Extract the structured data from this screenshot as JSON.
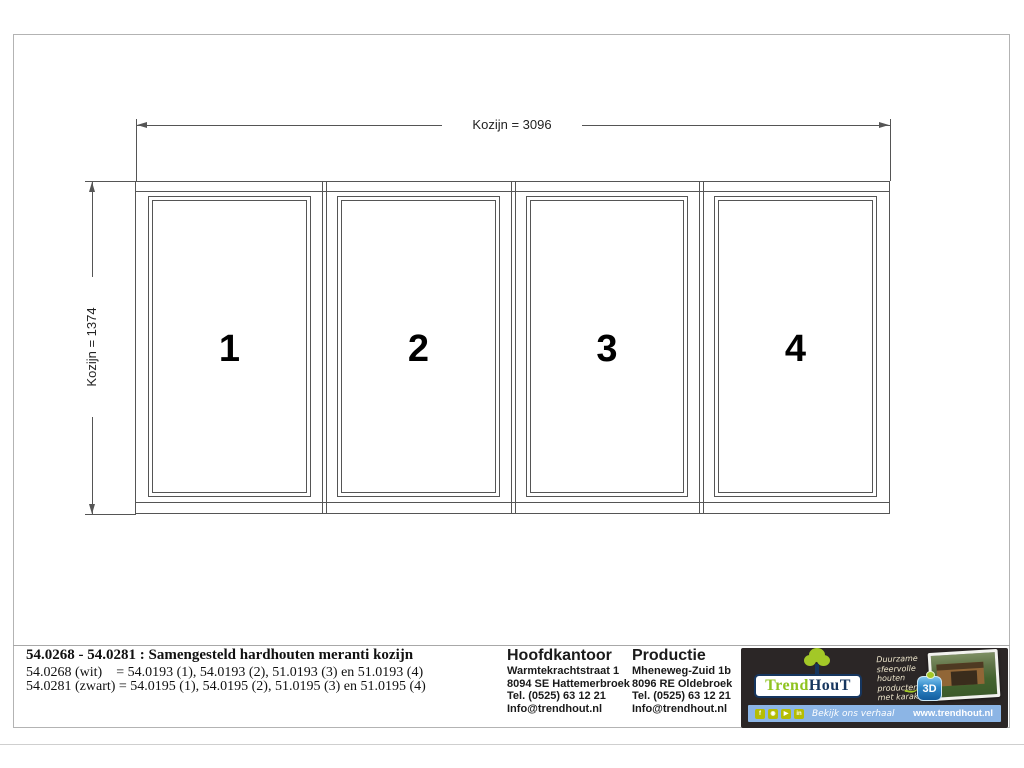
{
  "drawing": {
    "width_dimension_label": "Kozijn = 3096",
    "height_dimension_label": "Kozijn = 1374",
    "panel_numbers": [
      "1",
      "2",
      "3",
      "4"
    ]
  },
  "title_block": {
    "title": "54.0268 - 54.0281 : Samengesteld hardhouten meranti kozijn",
    "variant_lines": [
      "54.0268 (wit)    = 54.0193 (1), 54.0193 (2), 51.0193 (3) en 51.0193 (4)",
      "54.0281 (zwart) = 54.0195 (1), 54.0195 (2), 51.0195 (3) en 51.0195 (4)"
    ],
    "offices": [
      {
        "heading": "Hoofdkantoor",
        "lines": [
          "Warmtekrachtstraat 1",
          "8094 SE Hattemerbroek",
          "Tel. (0525) 63 12 21",
          "Info@trendhout.nl"
        ]
      },
      {
        "heading": "Productie",
        "lines": [
          "Mheneweg-Zuid 1b",
          "8096 RE Oldebroek",
          "Tel. (0525) 63 12 21",
          "Info@trendhout.nl"
        ]
      }
    ]
  },
  "branding": {
    "logo_part1": "Trend",
    "logo_part2": "HouT",
    "tagline": [
      "Duurzame sfeervolle",
      "houten producten",
      "met karakter"
    ],
    "badge_text": "3D",
    "social_caption": "Bekijk ons verhaal",
    "website": "www.trendhout.nl",
    "social_icons": [
      {
        "name": "facebook",
        "glyph": "f"
      },
      {
        "name": "instagram",
        "glyph": "◉"
      },
      {
        "name": "youtube",
        "glyph": "▶"
      },
      {
        "name": "linkedin",
        "glyph": "in"
      }
    ],
    "colors": {
      "lime": "#a3c827",
      "navy": "#16365f",
      "bar_blue": "#8cb5e5",
      "panel_black": "#2b2626"
    }
  }
}
